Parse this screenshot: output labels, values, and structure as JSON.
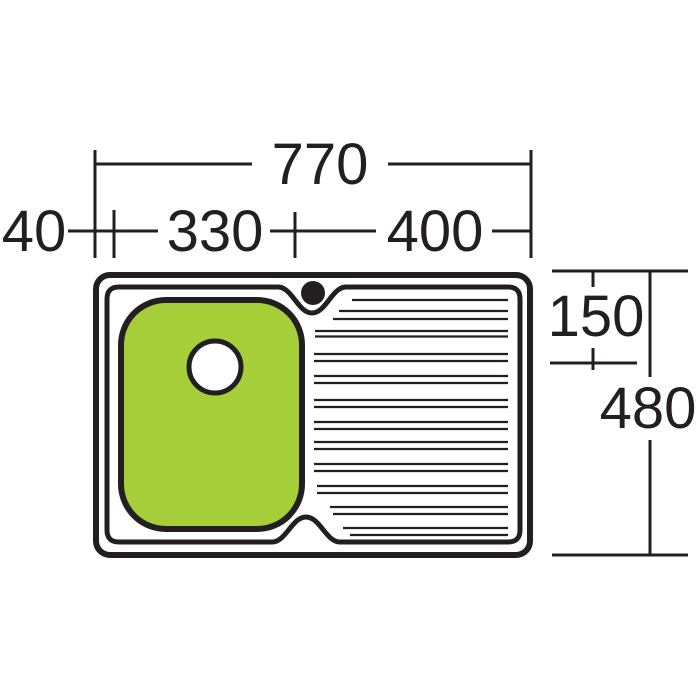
{
  "diagram": {
    "type": "kitchen-sink-top-view-dimension-drawing",
    "labels": {
      "overall_width": "770",
      "left_rim": "40",
      "bowl_width": "330",
      "drainer_width": "400",
      "tap_ledge_depth": "150",
      "overall_depth": "480"
    },
    "colors": {
      "ink": "#231f20",
      "bowl_fill": "#a6ce39",
      "background": "#ffffff"
    },
    "drainer_lines": {
      "x2": 508,
      "stroke_width": 2.2,
      "lines": [
        {
          "y": 300,
          "x1": 352
        },
        {
          "y": 311,
          "x1": 339
        },
        {
          "y": 319,
          "x1": 333
        },
        {
          "y": 331,
          "x1": 315
        },
        {
          "y": 336.5,
          "x1": 315
        },
        {
          "y": 354,
          "x1": 314
        },
        {
          "y": 361,
          "x1": 314
        },
        {
          "y": 376,
          "x1": 314
        },
        {
          "y": 383,
          "x1": 314
        },
        {
          "y": 400,
          "x1": 314
        },
        {
          "y": 407,
          "x1": 314
        },
        {
          "y": 422,
          "x1": 314
        },
        {
          "y": 429,
          "x1": 314
        },
        {
          "y": 442,
          "x1": 314
        },
        {
          "y": 449,
          "x1": 314
        },
        {
          "y": 464,
          "x1": 314
        },
        {
          "y": 471,
          "x1": 314
        },
        {
          "y": 486,
          "x1": 317
        },
        {
          "y": 493,
          "x1": 317
        },
        {
          "y": 507,
          "x1": 330
        },
        {
          "y": 514,
          "x1": 333
        },
        {
          "y": 528,
          "x1": 343
        },
        {
          "y": 535,
          "x1": 350
        }
      ]
    }
  }
}
